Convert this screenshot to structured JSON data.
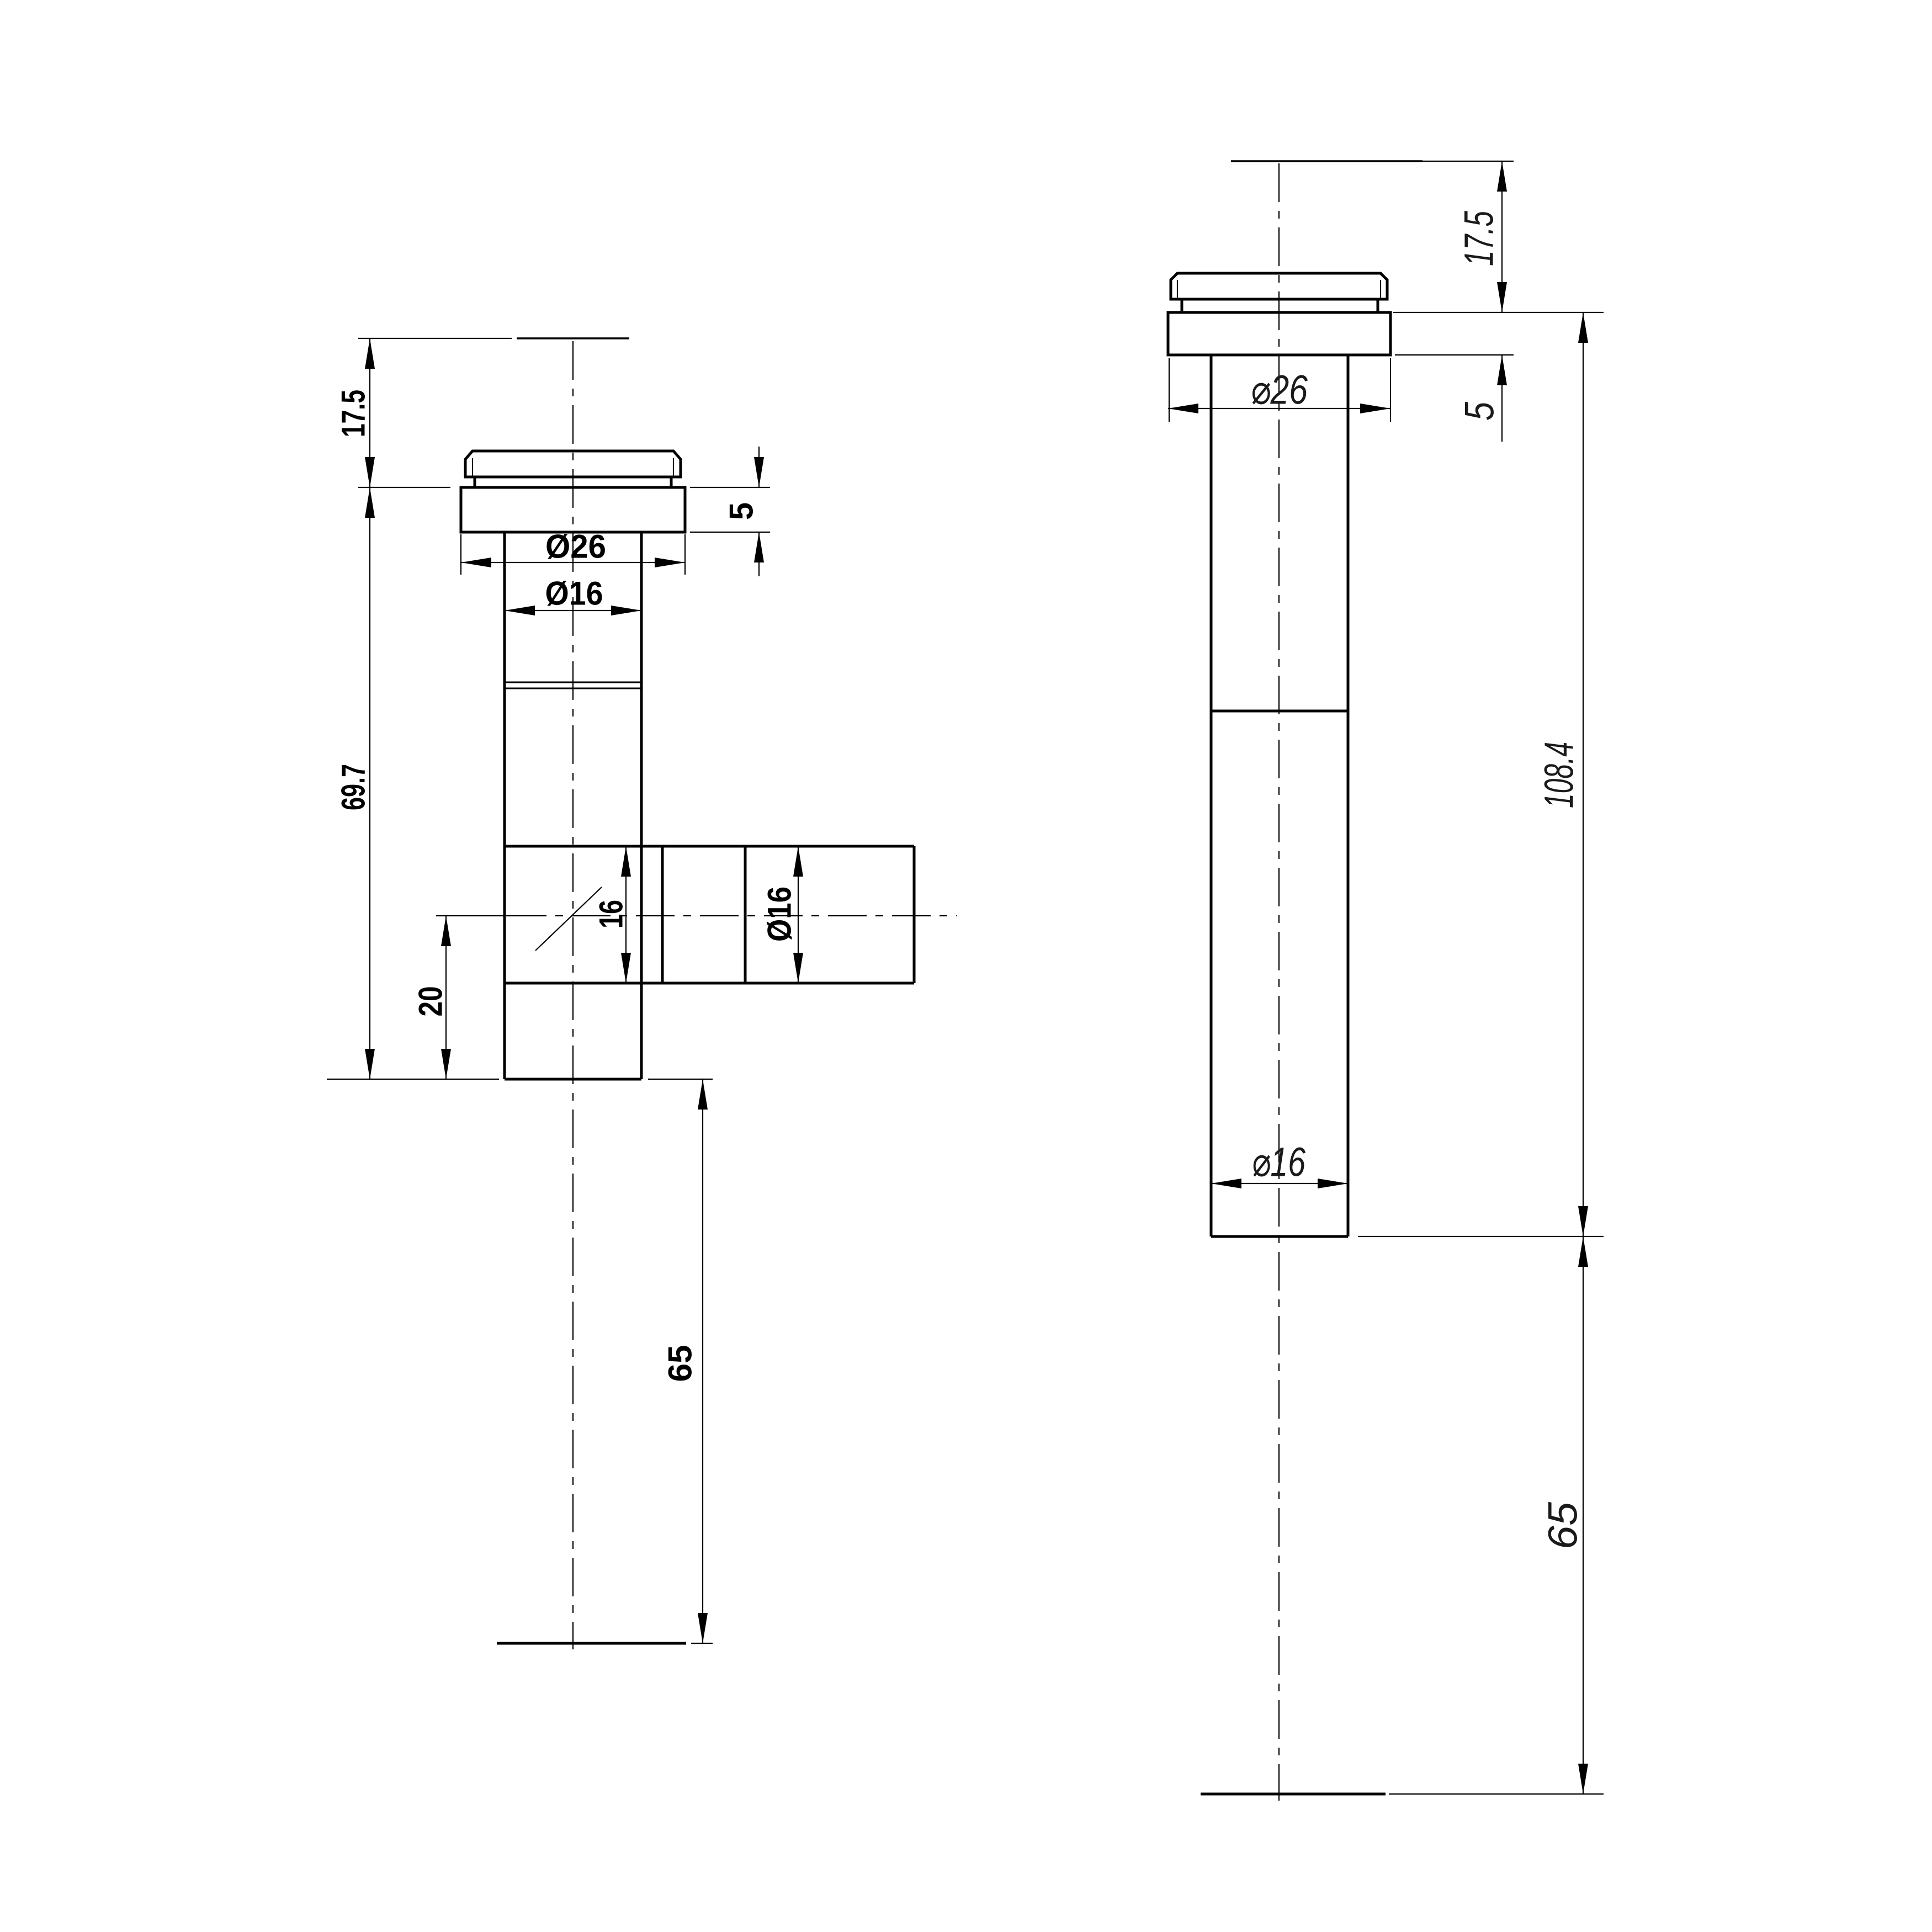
{
  "drawing": {
    "type": "technical-cad-drawing",
    "background_color": "#ffffff",
    "line_color": "#000000",
    "views_count": 2
  },
  "front_view": {
    "name": "front view (tee fitting with side branch)",
    "dims": {
      "overhang": "17.5",
      "body_length": "69.7",
      "branch_offset": "20",
      "tail_length": "65",
      "flange_dia": "Ø26",
      "pipe_dia": "Ø16",
      "flange_thickness": "5",
      "branch_square": "16",
      "branch_dia": "Ø16"
    }
  },
  "side_view": {
    "name": "side view (straight pipe)",
    "dims": {
      "overhang": "17.5",
      "flange_thickness": "5",
      "flange_dia": "⌀26",
      "total_length": "108.4",
      "tail_length": "65",
      "pipe_dia": "⌀16"
    }
  }
}
